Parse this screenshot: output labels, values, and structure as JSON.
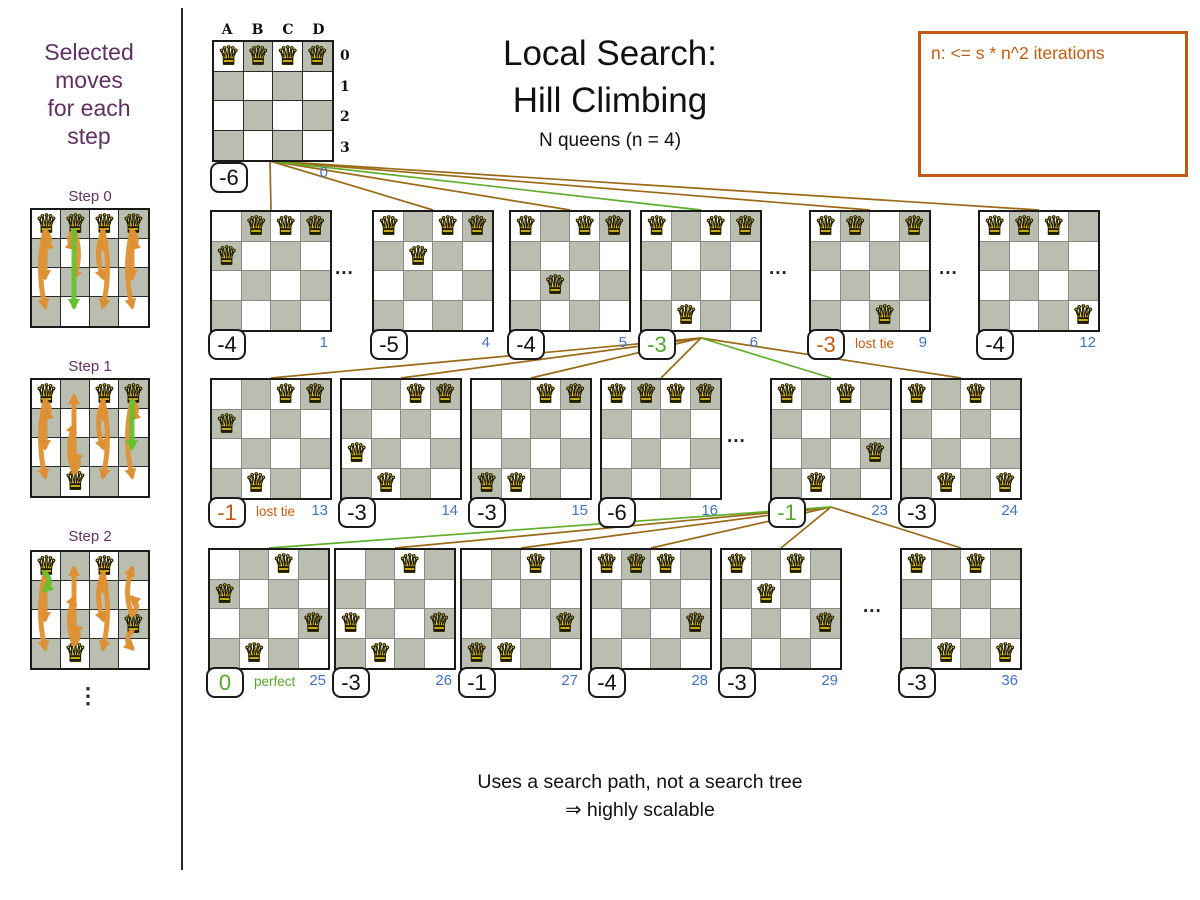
{
  "sidebar": {
    "title_lines": [
      "Selected",
      "moves",
      "for each",
      "step"
    ],
    "more_symbol": "⋮",
    "steps": [
      {
        "label": "Step 0",
        "queens": [
          [
            0,
            0
          ],
          [
            1,
            0
          ],
          [
            2,
            0
          ],
          [
            3,
            0
          ]
        ],
        "arrows": [
          {
            "col": 0,
            "from": 0,
            "to": 1,
            "color": "orange"
          },
          {
            "col": 0,
            "from": 0,
            "to": 2,
            "color": "orange"
          },
          {
            "col": 0,
            "from": 0,
            "to": 3,
            "color": "orange"
          },
          {
            "col": 1,
            "from": 0,
            "to": 1,
            "color": "orange"
          },
          {
            "col": 1,
            "from": 0,
            "to": 2,
            "color": "orange"
          },
          {
            "col": 1,
            "from": 0,
            "to": 3,
            "color": "green"
          },
          {
            "col": 2,
            "from": 0,
            "to": 1,
            "color": "orange"
          },
          {
            "col": 2,
            "from": 0,
            "to": 2,
            "color": "orange"
          },
          {
            "col": 2,
            "from": 0,
            "to": 3,
            "color": "orange"
          },
          {
            "col": 3,
            "from": 0,
            "to": 1,
            "color": "orange"
          },
          {
            "col": 3,
            "from": 0,
            "to": 2,
            "color": "orange"
          },
          {
            "col": 3,
            "from": 0,
            "to": 3,
            "color": "orange"
          }
        ]
      },
      {
        "label": "Step 1",
        "queens": [
          [
            0,
            0
          ],
          [
            2,
            0
          ],
          [
            3,
            0
          ],
          [
            1,
            3
          ]
        ],
        "arrows": [
          {
            "col": 0,
            "from": 0,
            "to": 1,
            "color": "orange"
          },
          {
            "col": 0,
            "from": 0,
            "to": 2,
            "color": "orange"
          },
          {
            "col": 0,
            "from": 0,
            "to": 3,
            "color": "orange"
          },
          {
            "col": 1,
            "from": 3,
            "to": 2,
            "color": "orange"
          },
          {
            "col": 1,
            "from": 3,
            "to": 1,
            "color": "orange"
          },
          {
            "col": 1,
            "from": 3,
            "to": 0,
            "color": "orange"
          },
          {
            "col": 2,
            "from": 0,
            "to": 1,
            "color": "orange"
          },
          {
            "col": 2,
            "from": 0,
            "to": 2,
            "color": "orange"
          },
          {
            "col": 2,
            "from": 0,
            "to": 3,
            "color": "orange"
          },
          {
            "col": 3,
            "from": 0,
            "to": 1,
            "color": "orange"
          },
          {
            "col": 3,
            "from": 0,
            "to": 3,
            "color": "orange"
          },
          {
            "col": 3,
            "from": 0,
            "to": 2,
            "color": "green"
          }
        ]
      },
      {
        "label": "Step 2",
        "queens": [
          [
            0,
            0
          ],
          [
            2,
            0
          ],
          [
            3,
            2
          ],
          [
            1,
            3
          ]
        ],
        "arrows": [
          {
            "col": 0,
            "from": 0,
            "to": 2,
            "color": "orange"
          },
          {
            "col": 0,
            "from": 0,
            "to": 3,
            "color": "orange"
          },
          {
            "col": 0,
            "from": 0,
            "to": 1,
            "color": "green"
          },
          {
            "col": 1,
            "from": 3,
            "to": 2,
            "color": "orange"
          },
          {
            "col": 1,
            "from": 3,
            "to": 1,
            "color": "orange"
          },
          {
            "col": 1,
            "from": 3,
            "to": 0,
            "color": "orange"
          },
          {
            "col": 2,
            "from": 0,
            "to": 1,
            "color": "orange"
          },
          {
            "col": 2,
            "from": 0,
            "to": 2,
            "color": "orange"
          },
          {
            "col": 2,
            "from": 0,
            "to": 3,
            "color": "orange"
          },
          {
            "col": 3,
            "from": 2,
            "to": 0,
            "color": "orange"
          },
          {
            "col": 3,
            "from": 2,
            "to": 1,
            "color": "orange"
          },
          {
            "col": 3,
            "from": 2,
            "to": 3,
            "color": "orange"
          }
        ]
      }
    ]
  },
  "header": {
    "title_line1": "Local Search:",
    "title_line2": "Hill Climbing",
    "subtitle": "N queens (n = 4)"
  },
  "note_box": {
    "text": "n: <= s * n^2 iterations"
  },
  "tree": {
    "ellipsis_symbol": "...",
    "root": {
      "index": "0",
      "score": "-6",
      "status": "normal",
      "col_labels": [
        "A",
        "B",
        "C",
        "D"
      ],
      "row_labels": [
        "0",
        "1",
        "2",
        "3"
      ],
      "queens": [
        [
          0,
          0
        ],
        [
          1,
          0
        ],
        [
          2,
          0
        ],
        [
          3,
          0
        ]
      ]
    },
    "levels": [
      {
        "boards": [
          {
            "index": "1",
            "score": "-4",
            "status": "normal",
            "tag": null,
            "queens": [
              [
                1,
                0
              ],
              [
                2,
                0
              ],
              [
                3,
                0
              ],
              [
                0,
                1
              ]
            ]
          },
          {
            "index": "4",
            "score": "-5",
            "status": "normal",
            "tag": null,
            "queens": [
              [
                0,
                0
              ],
              [
                2,
                0
              ],
              [
                3,
                0
              ],
              [
                1,
                1
              ]
            ]
          },
          {
            "index": "5",
            "score": "-4",
            "status": "normal",
            "tag": null,
            "queens": [
              [
                0,
                0
              ],
              [
                2,
                0
              ],
              [
                3,
                0
              ],
              [
                1,
                2
              ]
            ]
          },
          {
            "index": "6",
            "score": "-3",
            "status": "selected",
            "tag": null,
            "queens": [
              [
                0,
                0
              ],
              [
                2,
                0
              ],
              [
                3,
                0
              ],
              [
                1,
                3
              ]
            ]
          },
          {
            "index": "9",
            "score": "-3",
            "status": "lost_tie",
            "tag": "lost tie",
            "queens": [
              [
                0,
                0
              ],
              [
                1,
                0
              ],
              [
                3,
                0
              ],
              [
                2,
                3
              ]
            ]
          },
          {
            "index": "12",
            "score": "-4",
            "status": "normal",
            "tag": null,
            "queens": [
              [
                0,
                0
              ],
              [
                1,
                0
              ],
              [
                2,
                0
              ],
              [
                3,
                3
              ]
            ]
          }
        ]
      },
      {
        "boards": [
          {
            "index": "13",
            "score": "-1",
            "status": "lost_tie",
            "tag": "lost tie",
            "queens": [
              [
                2,
                0
              ],
              [
                3,
                0
              ],
              [
                0,
                1
              ],
              [
                1,
                3
              ]
            ]
          },
          {
            "index": "14",
            "score": "-3",
            "status": "normal",
            "tag": null,
            "queens": [
              [
                2,
                0
              ],
              [
                3,
                0
              ],
              [
                0,
                2
              ],
              [
                1,
                3
              ]
            ]
          },
          {
            "index": "15",
            "score": "-3",
            "status": "normal",
            "tag": null,
            "queens": [
              [
                2,
                0
              ],
              [
                3,
                0
              ],
              [
                0,
                3
              ],
              [
                1,
                3
              ]
            ]
          },
          {
            "index": "16",
            "score": "-6",
            "status": "normal",
            "tag": null,
            "queens": [
              [
                0,
                0
              ],
              [
                1,
                0
              ],
              [
                2,
                0
              ],
              [
                3,
                0
              ]
            ]
          },
          {
            "index": "23",
            "score": "-1",
            "status": "selected",
            "tag": null,
            "queens": [
              [
                0,
                0
              ],
              [
                2,
                0
              ],
              [
                3,
                2
              ],
              [
                1,
                3
              ]
            ]
          },
          {
            "index": "24",
            "score": "-3",
            "status": "normal",
            "tag": null,
            "queens": [
              [
                0,
                0
              ],
              [
                2,
                0
              ],
              [
                1,
                3
              ],
              [
                3,
                3
              ]
            ]
          }
        ]
      },
      {
        "boards": [
          {
            "index": "25",
            "score": "0",
            "status": "perfect",
            "tag": "perfect",
            "queens": [
              [
                2,
                0
              ],
              [
                0,
                1
              ],
              [
                3,
                2
              ],
              [
                1,
                3
              ]
            ]
          },
          {
            "index": "26",
            "score": "-3",
            "status": "normal",
            "tag": null,
            "queens": [
              [
                2,
                0
              ],
              [
                0,
                2
              ],
              [
                3,
                2
              ],
              [
                1,
                3
              ]
            ]
          },
          {
            "index": "27",
            "score": "-1",
            "status": "normal",
            "tag": null,
            "queens": [
              [
                2,
                0
              ],
              [
                3,
                2
              ],
              [
                0,
                3
              ],
              [
                1,
                3
              ]
            ]
          },
          {
            "index": "28",
            "score": "-4",
            "status": "normal",
            "tag": null,
            "queens": [
              [
                0,
                0
              ],
              [
                1,
                0
              ],
              [
                2,
                0
              ],
              [
                3,
                2
              ]
            ]
          },
          {
            "index": "29",
            "score": "-3",
            "status": "normal",
            "tag": null,
            "queens": [
              [
                0,
                0
              ],
              [
                2,
                0
              ],
              [
                1,
                1
              ],
              [
                3,
                2
              ]
            ]
          },
          {
            "index": "36",
            "score": "-3",
            "status": "normal",
            "tag": null,
            "queens": [
              [
                0,
                0
              ],
              [
                2,
                0
              ],
              [
                1,
                3
              ],
              [
                3,
                3
              ]
            ]
          }
        ]
      }
    ]
  },
  "footer": {
    "line1": "Uses a search path, not a search tree",
    "line2": "⇒ highly scalable"
  },
  "colors": {
    "purple": "#5f3061",
    "orange": "#c35a11",
    "green": "#55a828",
    "line_green": "#5fae2c",
    "line_brown": "#9a6a16",
    "blue": "#4472c4",
    "board_dark": "#b9beb1",
    "queen_fill": "#ffd821",
    "arrow_orange": "#dd9033",
    "arrow_green": "#66c02e"
  }
}
